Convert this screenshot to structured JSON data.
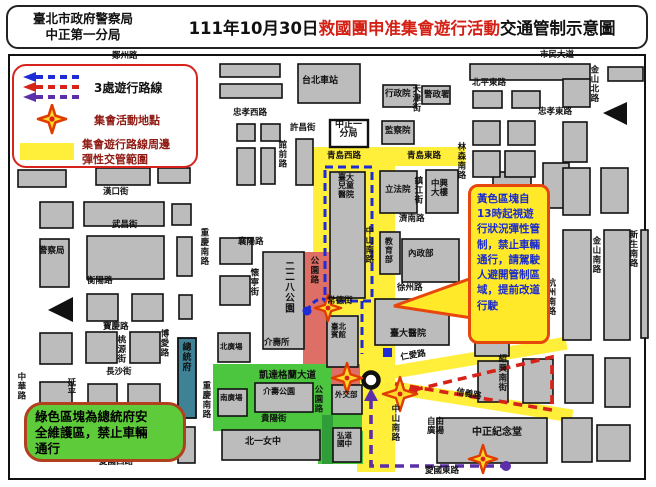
{
  "header": {
    "agency_line1": "臺北市政府警察局",
    "agency_line2": "中正第一分局",
    "title_prefix": "111年10月30日",
    "title_red": "救國團申准集會遊行活動",
    "title_suffix": "交通管制示意圖"
  },
  "legend": {
    "routes_label": "3處遊行路線",
    "star_label": "集會活動地點",
    "zone_label_line1": "集會遊行路線周邊",
    "zone_label_line2": "彈性交管範圍"
  },
  "callouts": {
    "yellow_text": "黃色區塊自13時起視遊行狀況彈性管制，禁止車輛通行，請駕駛人避開管制區域，提前改道行駛",
    "green_text_line1": "綠色區塊為總統府安",
    "green_text_line2": "全維護區，禁止車輛",
    "green_text_line3": "通行"
  },
  "colors": {
    "title_red": "#d42015",
    "building_gray": "#bcbcbc",
    "zone_yellow": "#ffee3a",
    "zone_red": "#dd6f66",
    "zone_green": "#4cc63e",
    "zone_green_dark": "#2f9e38",
    "presidential_teal": "#3f8296",
    "route_blue": "#1f2bd4",
    "route_red": "#d62219",
    "route_purple": "#5b2fa8",
    "star_fill": "#ffd829",
    "star_stroke": "#e03c00"
  },
  "map": {
    "streets": [
      {
        "t": "鄭州路",
        "x": 112,
        "y": 52
      },
      {
        "t": "市民大道",
        "x": 540,
        "y": 51
      },
      {
        "t": "忠孝西路",
        "x": 233,
        "y": 109
      },
      {
        "t": "北平東路",
        "x": 472,
        "y": 79
      },
      {
        "t": "忠孝東路",
        "x": 538,
        "y": 108
      },
      {
        "t": "天津街",
        "x": 411,
        "y": 84,
        "v": 1
      },
      {
        "t": "金山北路",
        "x": 589,
        "y": 65,
        "v": 1
      },
      {
        "t": "許昌街",
        "x": 290,
        "y": 124
      },
      {
        "t": "館前路",
        "x": 277,
        "y": 140,
        "v": 1
      },
      {
        "t": "青島西路",
        "x": 327,
        "y": 152
      },
      {
        "t": "青島東路",
        "x": 407,
        "y": 152
      },
      {
        "t": "林森南路",
        "x": 456,
        "y": 142,
        "v": 1
      },
      {
        "t": "鎮江街",
        "x": 413,
        "y": 176,
        "v": 1
      },
      {
        "t": "濟南路",
        "x": 399,
        "y": 215
      },
      {
        "t": "徐州路",
        "x": 397,
        "y": 284
      },
      {
        "t": "中山南路",
        "x": 364,
        "y": 226,
        "v": 1
      },
      {
        "t": "公園路",
        "x": 309,
        "y": 256,
        "v": 1
      },
      {
        "t": "常德街",
        "x": 327,
        "y": 297
      },
      {
        "t": "漢口街",
        "x": 103,
        "y": 188
      },
      {
        "t": "武昌街",
        "x": 112,
        "y": 221
      },
      {
        "t": "重慶南路",
        "x": 199,
        "y": 228,
        "v": 1
      },
      {
        "t": "衡陽路",
        "x": 87,
        "y": 277
      },
      {
        "t": "襄陽路",
        "x": 238,
        "y": 238
      },
      {
        "t": "懷寧街",
        "x": 249,
        "y": 268,
        "v": 1
      },
      {
        "t": "寶慶路",
        "x": 103,
        "y": 323
      },
      {
        "t": "桃源街",
        "x": 116,
        "y": 335,
        "v": 1
      },
      {
        "t": "博愛路",
        "x": 159,
        "y": 329,
        "v": 1
      },
      {
        "t": "長沙街",
        "x": 106,
        "y": 368
      },
      {
        "t": "延平",
        "x": 66,
        "y": 378,
        "v": 1
      },
      {
        "t": "中華路",
        "x": 16,
        "y": 372,
        "v": 1
      },
      {
        "t": "重慶南路",
        "x": 201,
        "y": 381,
        "v": 1
      },
      {
        "t": "貴陽街",
        "x": 261,
        "y": 415
      },
      {
        "t": "愛國西路",
        "x": 99,
        "y": 458
      },
      {
        "t": "愛國東路",
        "x": 425,
        "y": 467
      },
      {
        "t": "杭州南路",
        "x": 546,
        "y": 278,
        "v": 1
      },
      {
        "t": "金山南路",
        "x": 591,
        "y": 236,
        "v": 1
      },
      {
        "t": "新生南路",
        "x": 628,
        "y": 230,
        "v": 1
      },
      {
        "t": "紹興南街",
        "x": 497,
        "y": 354,
        "v": 1
      },
      {
        "t": "凱達格蘭大道",
        "x": 259,
        "y": 371,
        "s": 9.5
      },
      {
        "t": "公園路",
        "x": 313,
        "y": 385,
        "v": 1
      },
      {
        "t": "中山南路",
        "x": 390,
        "y": 404,
        "v": 1
      },
      {
        "t": "仁愛路",
        "x": 400,
        "y": 354,
        "r": -10
      },
      {
        "t": "信義路",
        "x": 457,
        "y": 388,
        "r": 11
      }
    ],
    "places": [
      {
        "t": "台北車站",
        "x": 302,
        "y": 77,
        "s": 9
      },
      {
        "t": "行政院",
        "x": 385,
        "y": 90
      },
      {
        "t": "警政署",
        "x": 424,
        "y": 91
      },
      {
        "lines": [
          "中正一",
          "分局"
        ],
        "x": 335,
        "y": 121,
        "s": 9
      },
      {
        "t": "監察院",
        "x": 385,
        "y": 127
      },
      {
        "lines": [
          "臺大",
          "兒童",
          "醫院"
        ],
        "x": 338,
        "y": 174,
        "s": 8
      },
      {
        "t": "立法院",
        "x": 385,
        "y": 186
      },
      {
        "lines": [
          "中興",
          "大樓"
        ],
        "x": 431,
        "y": 180
      },
      {
        "t": "教育部",
        "x": 384,
        "y": 237,
        "v": 1,
        "s": 8
      },
      {
        "t": "內政部",
        "x": 408,
        "y": 250
      },
      {
        "t": "警察局",
        "x": 39,
        "y": 247
      },
      {
        "t": "二二八公園",
        "x": 283,
        "y": 261,
        "v": 1,
        "s": 9.5
      },
      {
        "t": "介壽所",
        "x": 264,
        "y": 339
      },
      {
        "lines": [
          "臺北",
          "賓館"
        ],
        "x": 331,
        "y": 323,
        "s": 7.5
      },
      {
        "t": "臺大醫院",
        "x": 390,
        "y": 330,
        "s": 9
      },
      {
        "t": "總統府",
        "x": 180,
        "y": 342,
        "v": 1,
        "s": 9
      },
      {
        "t": "北廣場",
        "x": 220,
        "y": 343,
        "s": 7.5
      },
      {
        "t": "南廣場",
        "x": 220,
        "y": 394,
        "s": 7.5
      },
      {
        "t": "介壽公園",
        "x": 263,
        "y": 388,
        "s": 8
      },
      {
        "t": "外交部",
        "x": 335,
        "y": 391,
        "s": 7.5
      },
      {
        "t": "北一女中",
        "x": 245,
        "y": 438,
        "s": 9
      },
      {
        "lines": [
          "弘道",
          "國中"
        ],
        "x": 337,
        "y": 432,
        "s": 7.5
      },
      {
        "lines": [
          "自由",
          "廣場"
        ],
        "x": 427,
        "y": 418,
        "s": 8.5
      },
      {
        "t": "中正紀念堂",
        "x": 472,
        "y": 428,
        "s": 10
      }
    ]
  }
}
